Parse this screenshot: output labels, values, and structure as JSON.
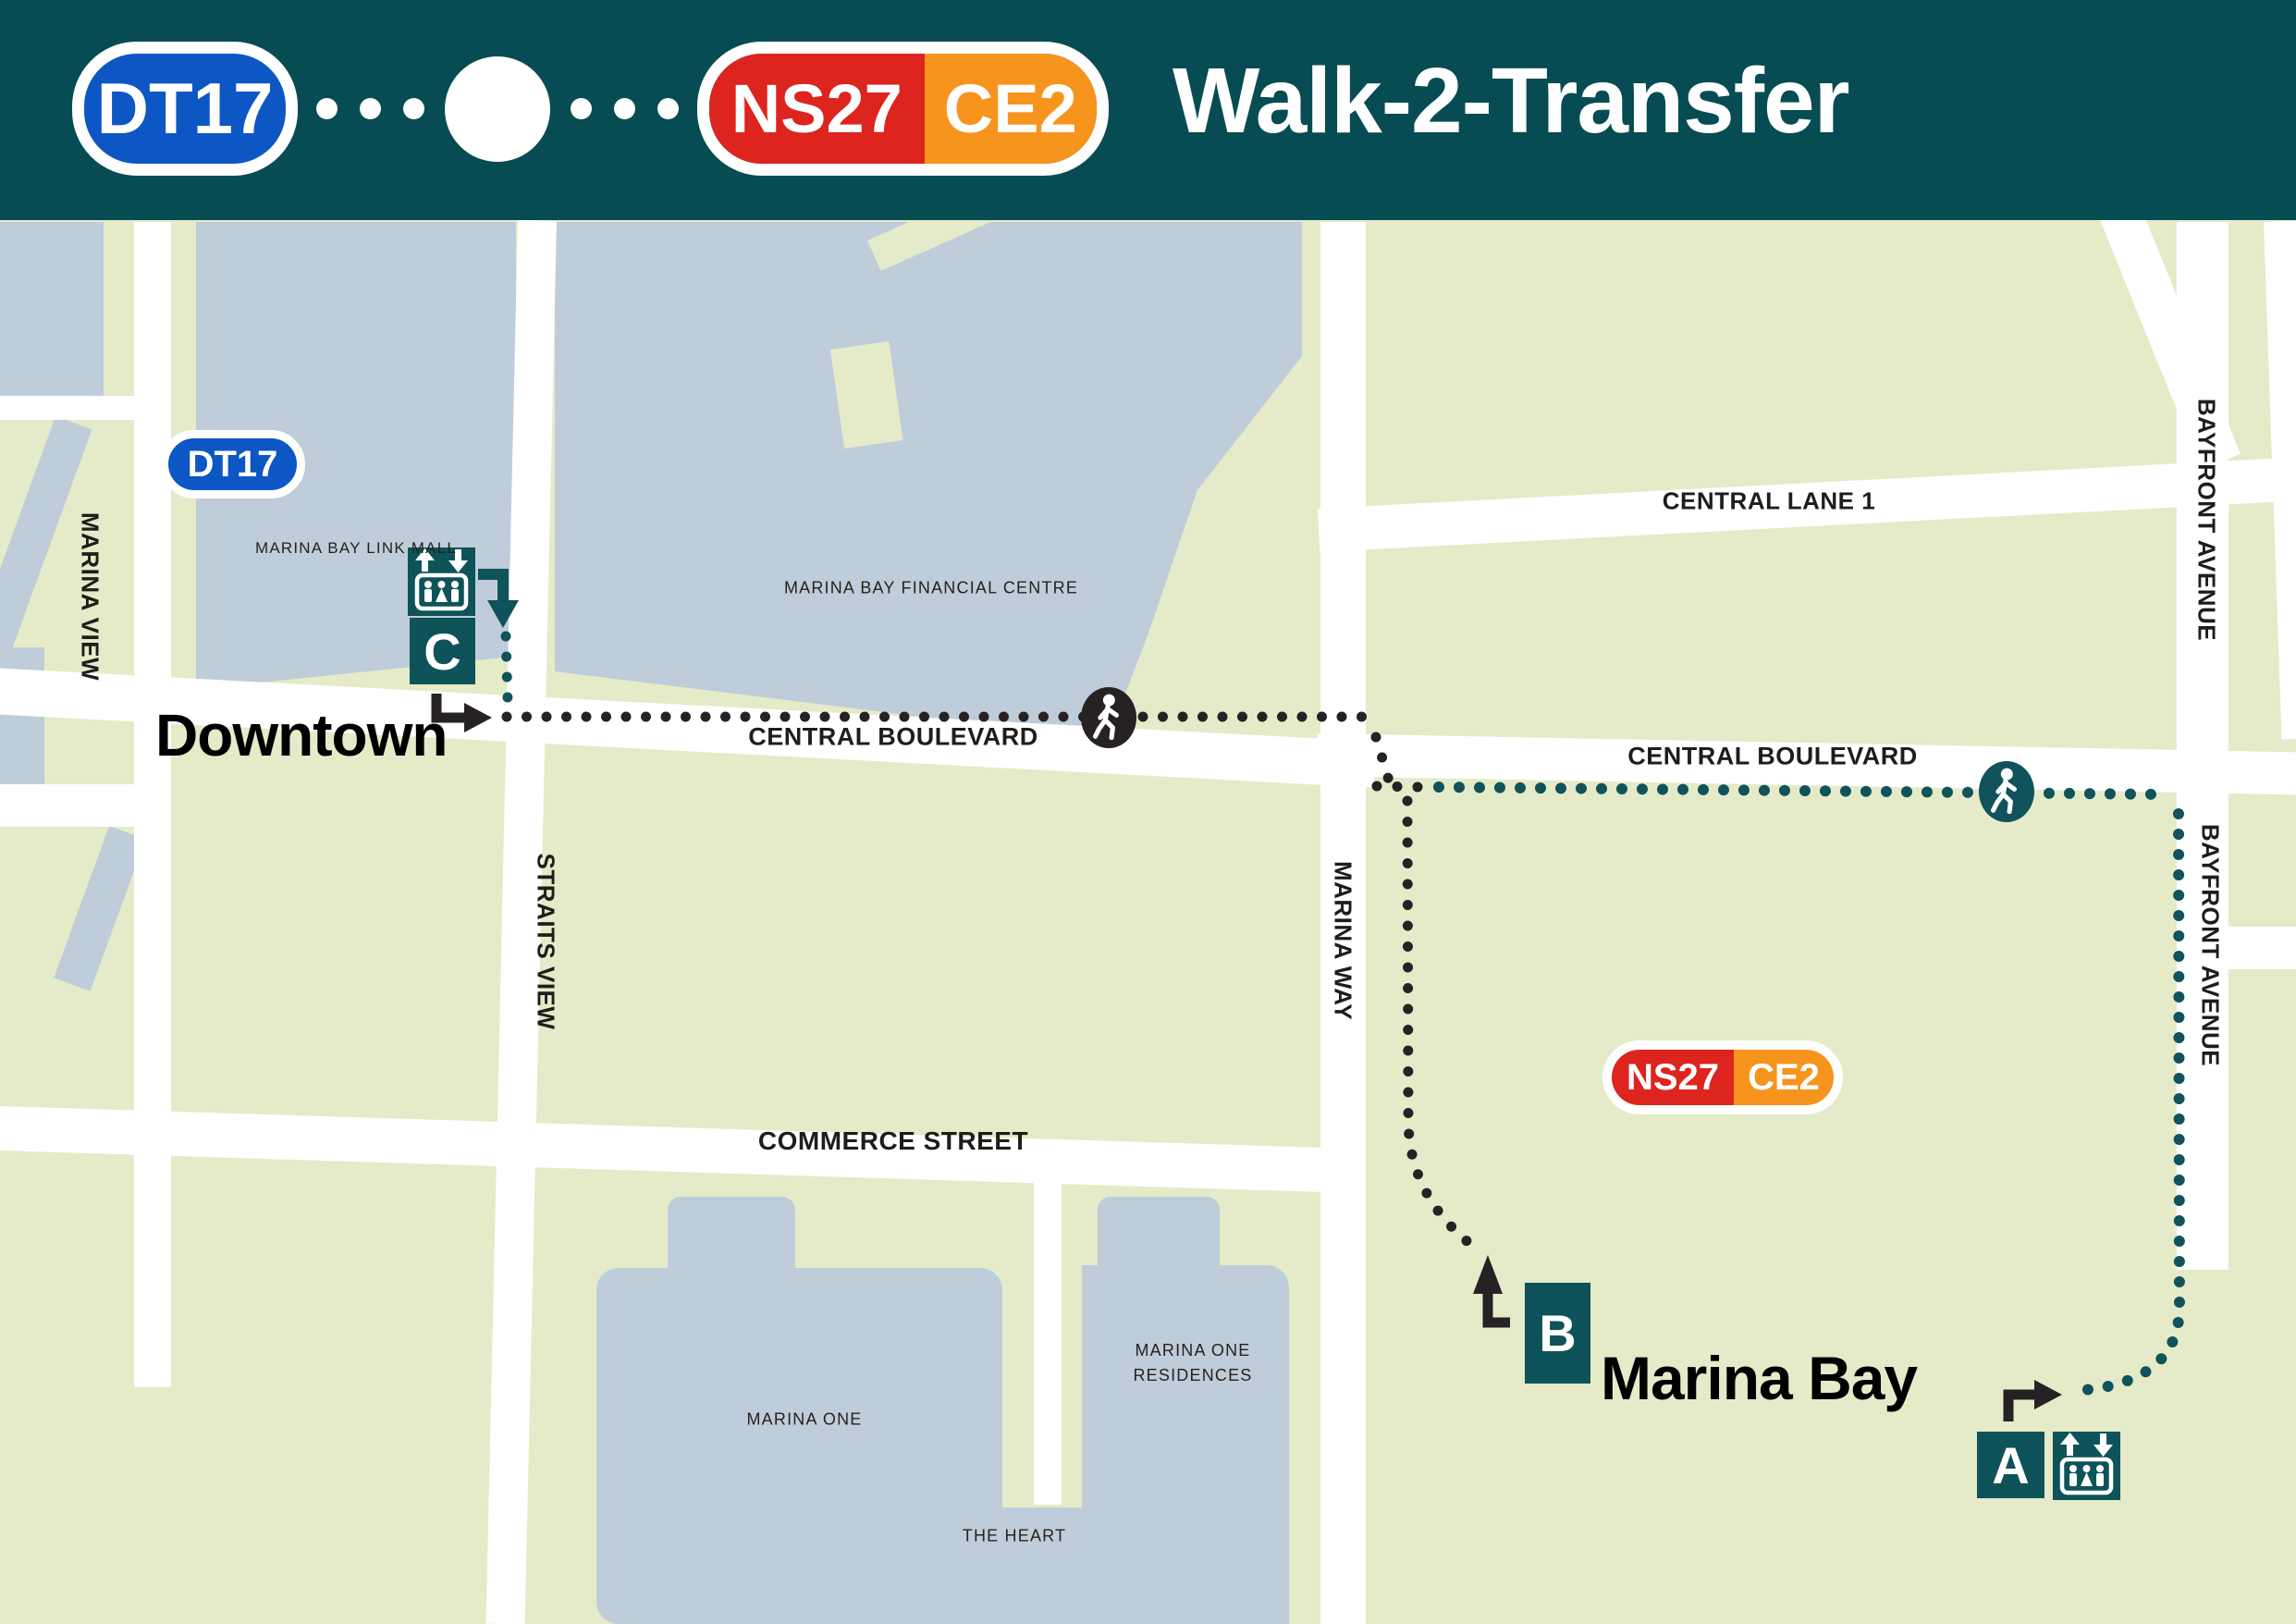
{
  "header": {
    "title": "Walk-2-Transfer",
    "walk_icon": "pedestrian-icon"
  },
  "badges": {
    "dt17": "DT17",
    "ns27": "NS27",
    "ce2": "CE2"
  },
  "colors": {
    "header_teal": "#074c52",
    "exit_teal": "#0e5359",
    "path_teal": "#10535a",
    "path_black": "#262223",
    "downtown_line_blue": "#0c57c4",
    "north_south_line_red": "#dd241f",
    "circle_line_orange": "#f7941d",
    "block_green": "#e5ebc8",
    "building_gray_blue": "#bfcdda",
    "street_white": "#ffffff"
  },
  "map": {
    "streets": {
      "central_lane_1": "CENTRAL LANE 1",
      "bayfront_avenue": "BAYFRONT AVENUE",
      "central_boulevard": "CENTRAL BOULEVARD",
      "marina_view": "MARINA VIEW",
      "straits_view": "STRAITS VIEW",
      "marina_way": "MARINA WAY",
      "commerce_street": "COMMERCE STREET"
    },
    "buildings": {
      "link_mall": "MARINA BAY LINK MALL",
      "financial_centre": "MARINA BAY FINANCIAL CENTRE",
      "marina_one": "MARINA ONE",
      "residences_line1": "MARINA ONE",
      "residences_line2": "RESIDENCES",
      "the_heart": "THE HEART"
    },
    "stations": {
      "downtown": {
        "name": "Downtown"
      },
      "marina_bay": {
        "name": "Marina Bay"
      }
    },
    "exits": {
      "a": "A",
      "b": "B",
      "c": "C"
    }
  }
}
